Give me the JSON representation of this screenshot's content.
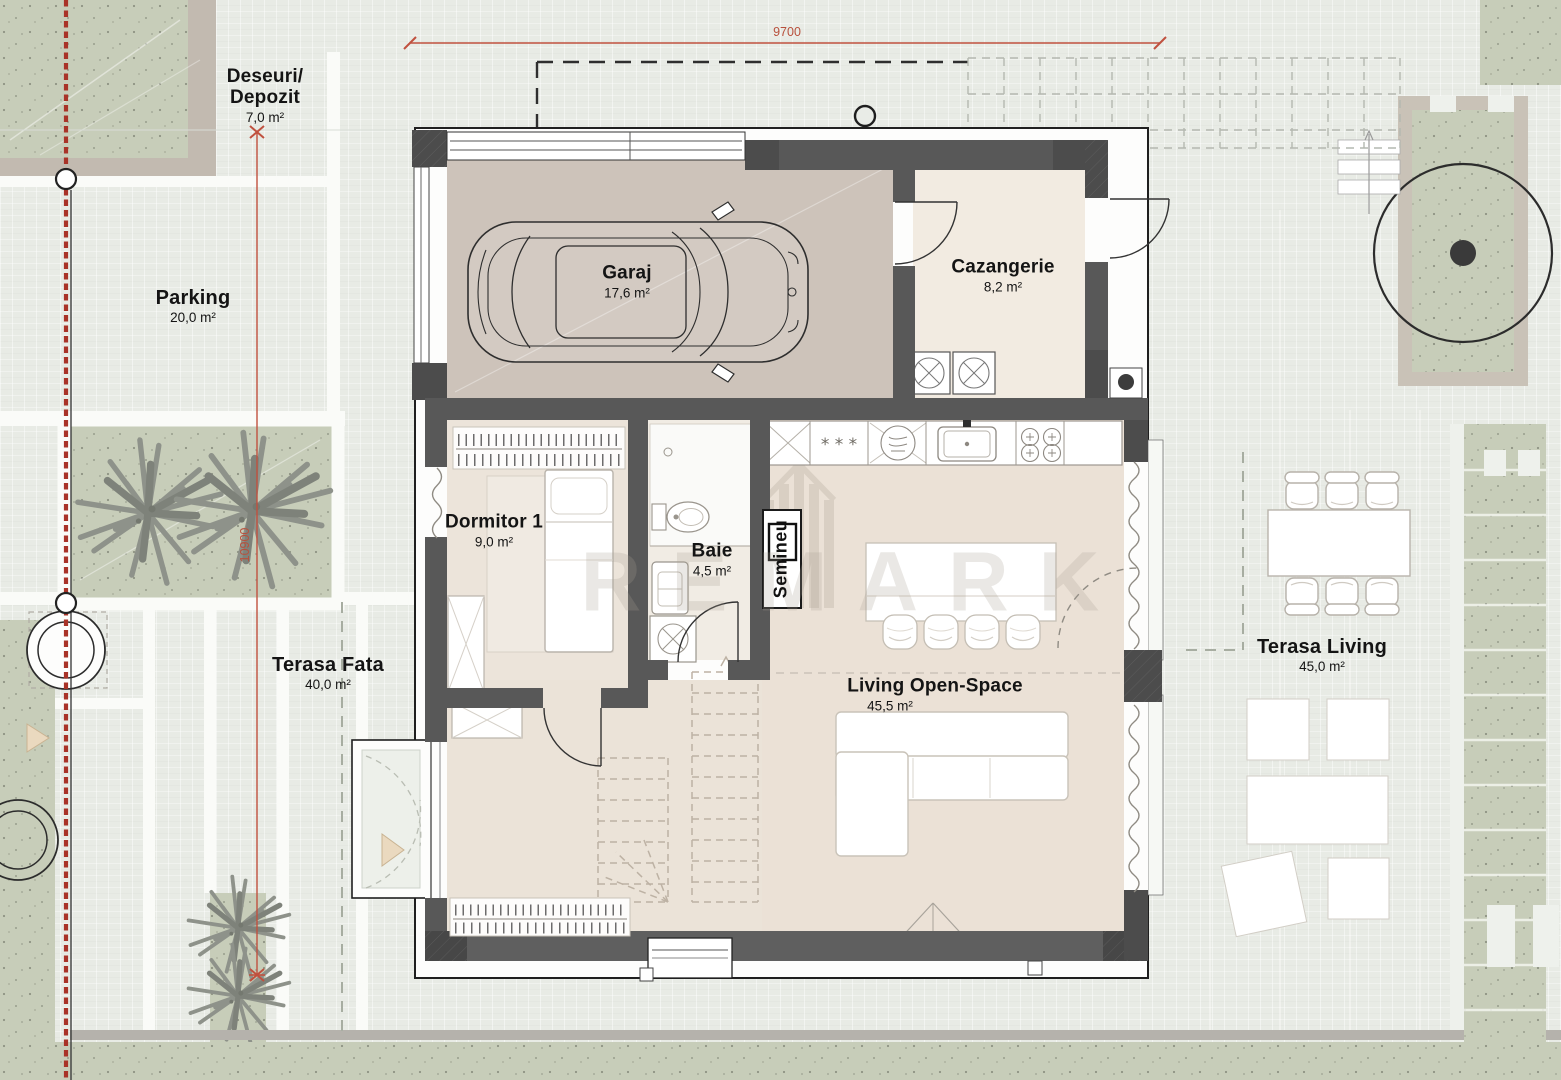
{
  "dimensions": {
    "top_width": "9700",
    "left_height": "10900"
  },
  "rooms": {
    "garaj": {
      "name": "Garaj",
      "area": "17,6 m²"
    },
    "cazangerie": {
      "name": "Cazangerie",
      "area": "8,2 m²"
    },
    "dormitor1": {
      "name": "Dormitor 1",
      "area": "9,0 m²"
    },
    "baie": {
      "name": "Baie",
      "area": "4,5 m²"
    },
    "living": {
      "name": "Living Open-Space",
      "area": "45,5 m²"
    },
    "semineu": {
      "name": "Semineu"
    }
  },
  "site": {
    "deseuri": {
      "name_line1": "Deseuri/",
      "name_line2": "Depozit",
      "area": "7,0 m²"
    },
    "parking": {
      "name": "Parking",
      "area": "20,0 m²"
    },
    "terasa_fata": {
      "name": "Terasa Fata",
      "area": "40,0 m²"
    },
    "terasa_living": {
      "name": "Terasa Living",
      "area": "45,0 m²"
    }
  },
  "watermark": {
    "text": "REMARK"
  },
  "colors": {
    "dimension_red": "#b8503c",
    "property_line_red": "#a93328",
    "wall_gray": "#585858",
    "garage_floor": "#cdc3ba",
    "interior_floor": "#ece4da",
    "greenery": "#c7cdb9",
    "site_background": "#e8ebe5"
  }
}
